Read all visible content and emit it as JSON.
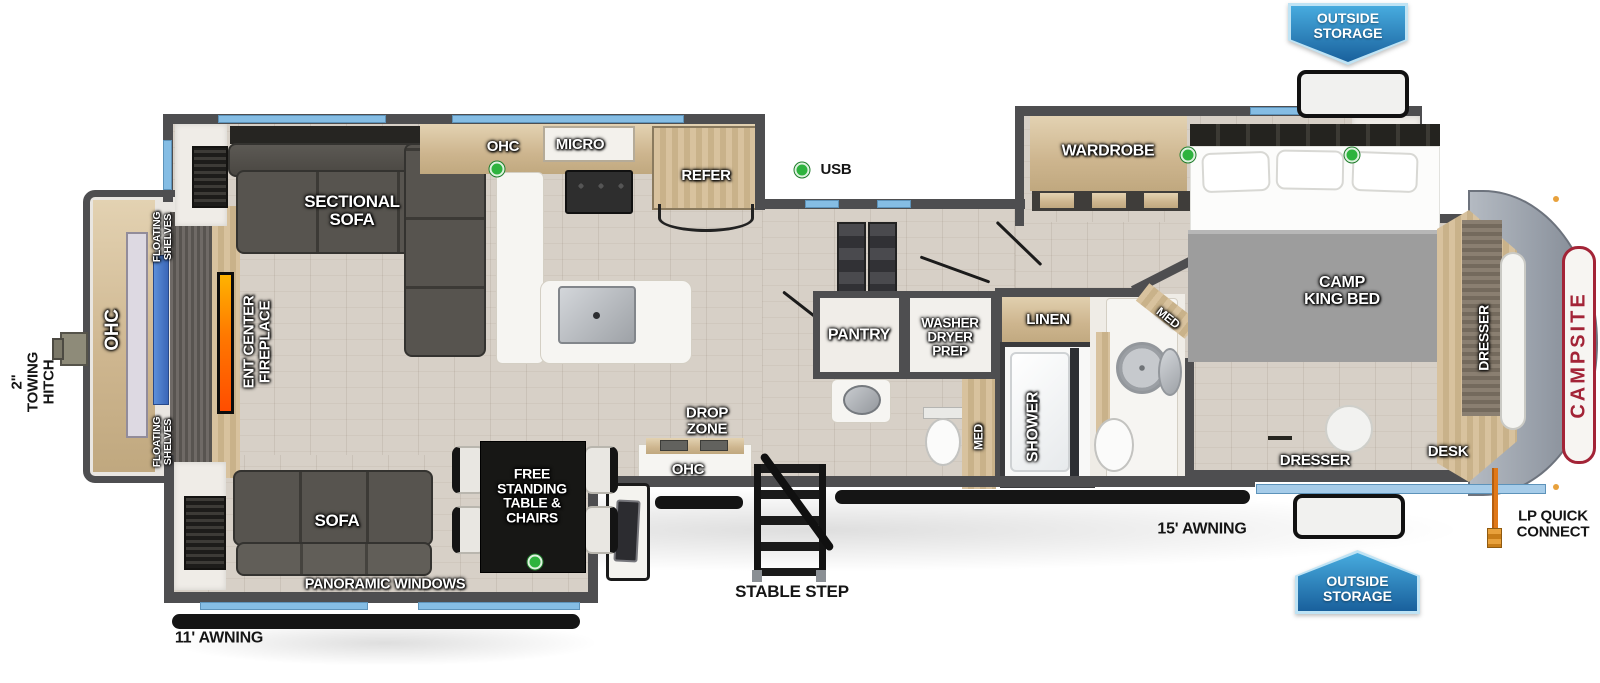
{
  "brand": {
    "name": "CAMPSITE"
  },
  "legend": {
    "usb": "USB"
  },
  "colors": {
    "badge_blue": "#19609c",
    "brand_red": "#a32437",
    "usb_green": "#2eb33e",
    "window_blue": "#85bde4",
    "wall_gray": "#4e4e50"
  },
  "exterior": {
    "towing_hitch": "2\" TOWING HITCH",
    "outside_storage_top": "OUTSIDE STORAGE",
    "outside_storage_bottom": "OUTSIDE STORAGE",
    "awning_15": "15' AWNING",
    "awning_11": "11' AWNING",
    "lp_quick_connect": "LP QUICK CONNECT",
    "stable_step": "STABLE STEP"
  },
  "rear_living": {
    "ohc": "OHC",
    "floating_shelves_top": "FLOATING SHELVES",
    "floating_shelves_bottom": "FLOATING SHELVES",
    "ent_center_fireplace": "ENT CENTER FIREPLACE",
    "sectional_sofa": "SECTIONAL SOFA",
    "sofa": "SOFA",
    "panoramic_windows": "PANORAMIC WINDOWS",
    "free_standing_table": "FREE STANDING TABLE & CHAIRS"
  },
  "kitchen": {
    "ohc": "OHC",
    "micro": "MICRO",
    "refer": "REFER",
    "drop_zone": "DROP ZONE",
    "drop_zone_ohc": "OHC",
    "pantry": "PANTRY"
  },
  "bath": {
    "washer_dryer_prep": "WASHER DRYER PREP",
    "med_mid": "MED",
    "linen": "LINEN",
    "shower": "SHOWER",
    "med_main": "MED"
  },
  "bedroom": {
    "wardrobe": "WARDROBE",
    "camp_king_bed": "CAMP KING BED",
    "dresser_side": "DRESSER",
    "dresser_rear": "DRESSER",
    "desk": "DESK"
  }
}
